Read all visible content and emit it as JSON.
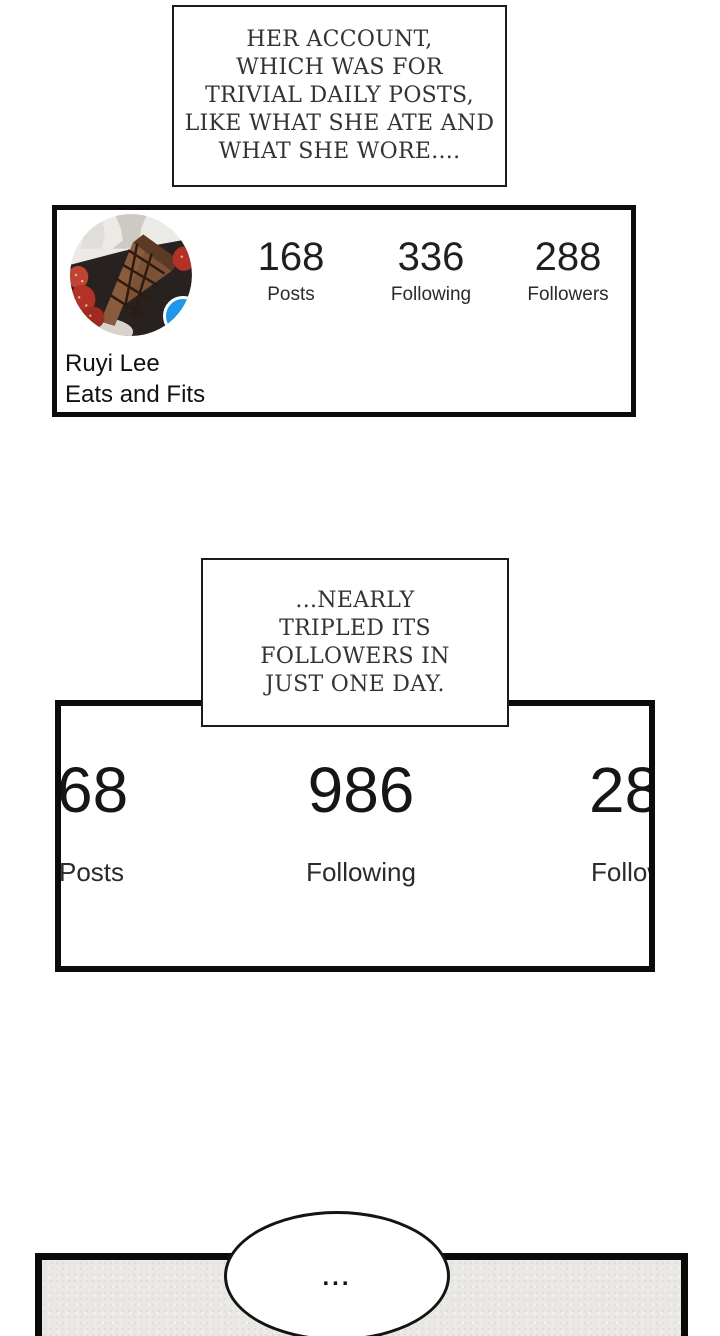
{
  "captions": {
    "top": "HER ACCOUNT,\nWHICH WAS FOR\nTRIVIAL DAILY POSTS,\nLIKE WHAT SHE ATE AND\nWHAT SHE WORE....",
    "middle": "...NEARLY\nTRIPLED ITS\nFOLLOWERS IN\nJUST ONE DAY."
  },
  "profile_card": {
    "name": "Ruyi Lee",
    "bio": "Eats and Fits",
    "avatar_description": "chocolate cake slice with strawberries on dark plate",
    "add_button_label": "+",
    "stats": [
      {
        "value": "168",
        "label": "Posts"
      },
      {
        "value": "336",
        "label": "Following"
      },
      {
        "value": "288",
        "label": "Followers"
      }
    ]
  },
  "zoomed_card": {
    "stats": [
      {
        "value": "68",
        "label": "Posts"
      },
      {
        "value": "986",
        "label": "Following"
      },
      {
        "value": "28",
        "label": "Followers"
      }
    ]
  },
  "speech_bubble": {
    "text": "..."
  },
  "colors": {
    "accent_blue": "#1f98ea",
    "panel_border": "#0c0c0c",
    "caption_text": "#333333",
    "bottom_panel_fill": "#e9e8e4"
  }
}
